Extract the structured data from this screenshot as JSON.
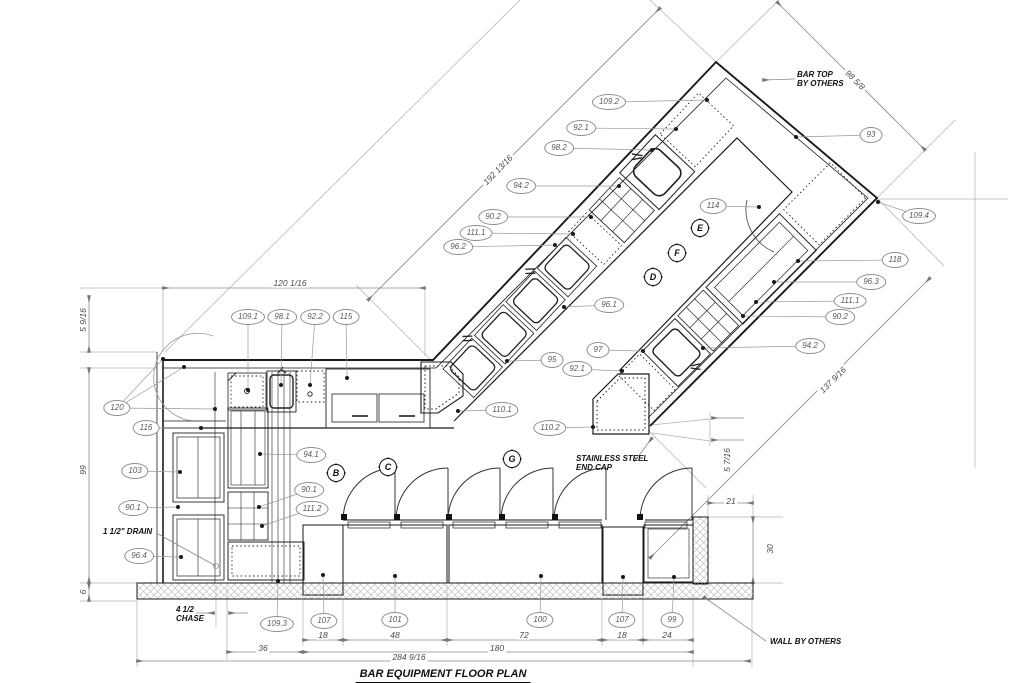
{
  "drawing": {
    "title": "BAR EQUIPMENT FLOOR PLAN"
  },
  "colors": {
    "line": "#1a1a1a",
    "dim_line": "#8a8a8a",
    "dim_text": "#4a4a4a",
    "callout_stroke": "#8f8f8f",
    "hatch": "#b5b5b5"
  },
  "callouts": [
    {
      "label": "109.2",
      "x": 609,
      "y": 102,
      "targets": [
        [
          707,
          100
        ]
      ]
    },
    {
      "label": "92.1",
      "x": 581,
      "y": 128,
      "targets": [
        [
          676,
          129
        ]
      ]
    },
    {
      "label": "98.2",
      "x": 559,
      "y": 148,
      "targets": [
        [
          652,
          150
        ]
      ]
    },
    {
      "label": "94.2",
      "x": 521,
      "y": 186,
      "targets": [
        [
          619,
          186
        ]
      ]
    },
    {
      "label": "90.2",
      "x": 493,
      "y": 217,
      "targets": [
        [
          591,
          217
        ]
      ]
    },
    {
      "label": "111.1",
      "x": 476,
      "y": 233,
      "targets": [
        [
          573,
          234
        ]
      ]
    },
    {
      "label": "96.2",
      "x": 458,
      "y": 247,
      "targets": [
        [
          555,
          245
        ]
      ]
    },
    {
      "label": "93",
      "x": 871,
      "y": 135,
      "targets": [
        [
          796,
          137
        ]
      ]
    },
    {
      "label": "109.4",
      "x": 919,
      "y": 216,
      "targets": [
        [
          878,
          202
        ]
      ]
    },
    {
      "label": "118",
      "x": 895,
      "y": 260,
      "targets": [
        [
          798,
          261
        ]
      ]
    },
    {
      "label": "96.3",
      "x": 871,
      "y": 282,
      "targets": [
        [
          774,
          282
        ]
      ]
    },
    {
      "label": "111.1",
      "x": 850,
      "y": 301,
      "targets": [
        [
          756,
          302
        ]
      ]
    },
    {
      "label": "90.2",
      "x": 840,
      "y": 317,
      "targets": [
        [
          743,
          316
        ]
      ]
    },
    {
      "label": "94.2",
      "x": 810,
      "y": 346,
      "targets": [
        [
          703,
          348
        ]
      ]
    },
    {
      "label": "96.1",
      "x": 609,
      "y": 305,
      "targets": [
        [
          564,
          307
        ]
      ]
    },
    {
      "label": "95",
      "x": 552,
      "y": 360,
      "targets": [
        [
          507,
          361
        ]
      ]
    },
    {
      "label": "97",
      "x": 598,
      "y": 350,
      "targets": [
        [
          643,
          351
        ]
      ]
    },
    {
      "label": "92.1",
      "x": 577,
      "y": 369,
      "targets": [
        [
          622,
          371
        ]
      ]
    },
    {
      "label": "110.1",
      "x": 502,
      "y": 410,
      "targets": [
        [
          458,
          411
        ]
      ]
    },
    {
      "label": "110.2",
      "x": 550,
      "y": 428,
      "targets": [
        [
          593,
          427
        ]
      ]
    },
    {
      "label": "114",
      "x": 713,
      "y": 206,
      "targets": [
        [
          759,
          207
        ]
      ]
    },
    {
      "label": "109.1",
      "x": 248,
      "y": 317,
      "targets": [
        [
          248,
          390
        ]
      ]
    },
    {
      "label": "98.1",
      "x": 282,
      "y": 317,
      "targets": [
        [
          281,
          385
        ]
      ]
    },
    {
      "label": "92.2",
      "x": 315,
      "y": 317,
      "targets": [
        [
          310,
          385
        ]
      ]
    },
    {
      "label": "115",
      "x": 346,
      "y": 317,
      "targets": [
        [
          347,
          378
        ]
      ]
    },
    {
      "label": "120",
      "x": 117,
      "y": 408,
      "targets": [
        [
          163,
          359
        ],
        [
          184,
          367
        ],
        [
          215,
          409
        ]
      ]
    },
    {
      "label": "116",
      "x": 146,
      "y": 428,
      "targets": [
        [
          201,
          428
        ]
      ]
    },
    {
      "label": "103",
      "x": 135,
      "y": 471,
      "targets": [
        [
          180,
          472
        ]
      ]
    },
    {
      "label": "90.1",
      "x": 133,
      "y": 508,
      "targets": [
        [
          178,
          507
        ]
      ]
    },
    {
      "label": "96.4",
      "x": 139,
      "y": 556,
      "targets": [
        [
          181,
          557
        ]
      ]
    },
    {
      "label": "94.1",
      "x": 311,
      "y": 455,
      "targets": [
        [
          260,
          454
        ]
      ]
    },
    {
      "label": "90.1",
      "x": 309,
      "y": 490,
      "targets": [
        [
          259,
          507
        ]
      ]
    },
    {
      "label": "111.2",
      "x": 312,
      "y": 509,
      "targets": [
        [
          262,
          526
        ]
      ]
    },
    {
      "label": "109.3",
      "x": 277,
      "y": 624,
      "targets": [
        [
          278,
          581
        ]
      ]
    },
    {
      "label": "107",
      "x": 324,
      "y": 621,
      "targets": [
        [
          323,
          575
        ]
      ]
    },
    {
      "label": "101",
      "x": 395,
      "y": 620,
      "targets": [
        [
          395,
          576
        ]
      ]
    },
    {
      "label": "100",
      "x": 540,
      "y": 620,
      "targets": [
        [
          541,
          576
        ]
      ]
    },
    {
      "label": "107",
      "x": 622,
      "y": 620,
      "targets": [
        [
          623,
          577
        ]
      ]
    },
    {
      "label": "99",
      "x": 672,
      "y": 620,
      "targets": [
        [
          674,
          577
        ]
      ]
    }
  ],
  "section_markers": [
    {
      "letter": "B",
      "x": 336,
      "y": 473
    },
    {
      "letter": "C",
      "x": 388,
      "y": 467
    },
    {
      "letter": "D",
      "x": 653,
      "y": 277
    },
    {
      "letter": "E",
      "x": 700,
      "y": 228
    },
    {
      "letter": "F",
      "x": 677,
      "y": 253
    },
    {
      "letter": "G",
      "x": 512,
      "y": 459
    }
  ],
  "dim_labels": [
    {
      "label": "120 1/16",
      "x": 290,
      "y": 283,
      "rot": 0
    },
    {
      "label": "5 9/16",
      "x": 83,
      "y": 320,
      "rot": -90
    },
    {
      "label": "99",
      "x": 83,
      "y": 470,
      "rot": -90
    },
    {
      "label": "6",
      "x": 83,
      "y": 592,
      "rot": -90
    },
    {
      "label": "192 13/16",
      "x": 498,
      "y": 170,
      "rot": -46
    },
    {
      "label": "98 5/8",
      "x": 855,
      "y": 80,
      "rot": 46
    },
    {
      "label": "137 9/16",
      "x": 833,
      "y": 380,
      "rot": -45
    },
    {
      "label": "5 7/16",
      "x": 727,
      "y": 460,
      "rot": -90
    },
    {
      "label": "21",
      "x": 731,
      "y": 501,
      "rot": 0
    },
    {
      "label": "30",
      "x": 770,
      "y": 549,
      "rot": -90
    },
    {
      "label": "36",
      "x": 263,
      "y": 648,
      "rot": 0
    },
    {
      "label": "18",
      "x": 323,
      "y": 635,
      "rot": 0
    },
    {
      "label": "48",
      "x": 395,
      "y": 635,
      "rot": 0
    },
    {
      "label": "72",
      "x": 524,
      "y": 635,
      "rot": 0
    },
    {
      "label": "18",
      "x": 622,
      "y": 635,
      "rot": 0
    },
    {
      "label": "24",
      "x": 667,
      "y": 635,
      "rot": 0
    },
    {
      "label": "180",
      "x": 497,
      "y": 648,
      "rot": 0
    },
    {
      "label": "284 9/16",
      "x": 409,
      "y": 657,
      "rot": 0
    }
  ],
  "notes": [
    {
      "id": "bar-top-note",
      "lines": [
        "BAR TOP",
        "BY OTHERS"
      ],
      "x": 797,
      "y": 70,
      "leader": [
        795,
        79,
        763,
        80
      ],
      "end": "arrow"
    },
    {
      "id": "end-cap-note",
      "lines": [
        "STAINLESS STEEL",
        "END CAP"
      ],
      "x": 576,
      "y": 454,
      "leader": [
        634,
        462,
        652,
        438
      ],
      "end": "arrow"
    },
    {
      "id": "wall-note",
      "lines": [
        "WALL BY OTHERS"
      ],
      "x": 770,
      "y": 637,
      "leader": [
        766,
        641,
        704,
        597
      ],
      "end": "arrow"
    },
    {
      "id": "drain-note",
      "lines": [
        "1 1/2\" DRAIN"
      ],
      "x": 103,
      "y": 527,
      "leader": [
        158,
        534,
        216,
        566
      ],
      "end": "circle"
    },
    {
      "id": "chase-note",
      "lines": [
        "4 1/2",
        "CHASE"
      ],
      "x": 176,
      "y": 605
    }
  ]
}
